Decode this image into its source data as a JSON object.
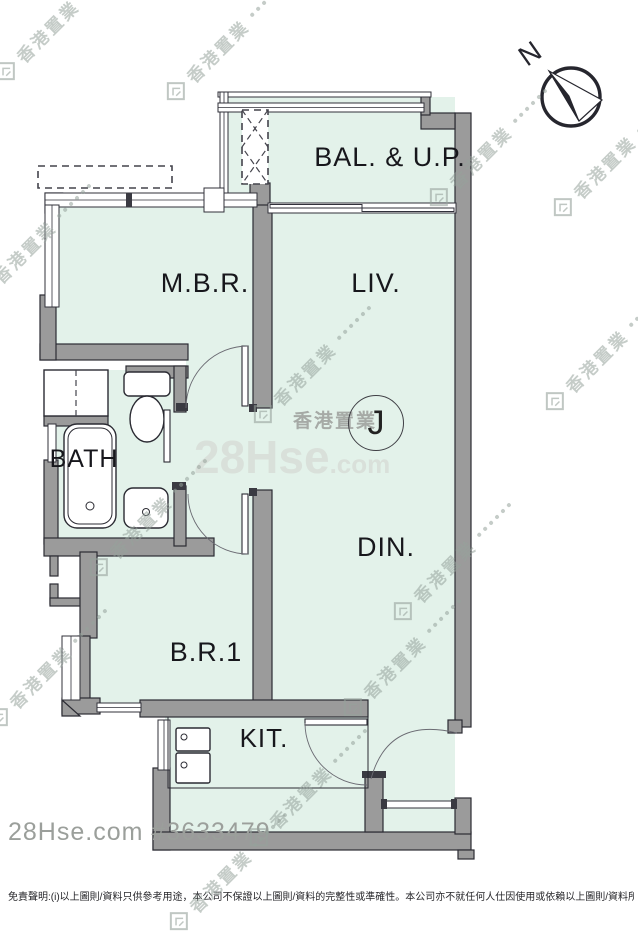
{
  "floorplan": {
    "unit_label": "J",
    "compass_label": "N",
    "rooms": [
      {
        "id": "bal",
        "label": "BAL. & U.P."
      },
      {
        "id": "mbr",
        "label": "M.B.R."
      },
      {
        "id": "liv",
        "label": "LIV."
      },
      {
        "id": "bath",
        "label": "BATH"
      },
      {
        "id": "din",
        "label": "DIN."
      },
      {
        "id": "br1",
        "label": "B.R.1"
      },
      {
        "id": "kit",
        "label": "KIT."
      }
    ]
  },
  "watermarks": {
    "brand_cjk": "香港置業",
    "site_name": "28Hse",
    "site_tld": ".com"
  },
  "footer": {
    "listing_ref": "28Hse.com #3633479",
    "disclaimer": "免責聲明:(i)以上圖則/資料只供參考用途，本公司不保證以上圖則/資料的完整性或準確性。本公司亦不就任何人仕因使用或依賴以上圖則/資料所引致之任何損失或損害"
  },
  "colors": {
    "floor": "#e3f2ea",
    "wall": "#9b9b9b",
    "wall_outline": "#2b2b33",
    "text": "#17171c"
  }
}
